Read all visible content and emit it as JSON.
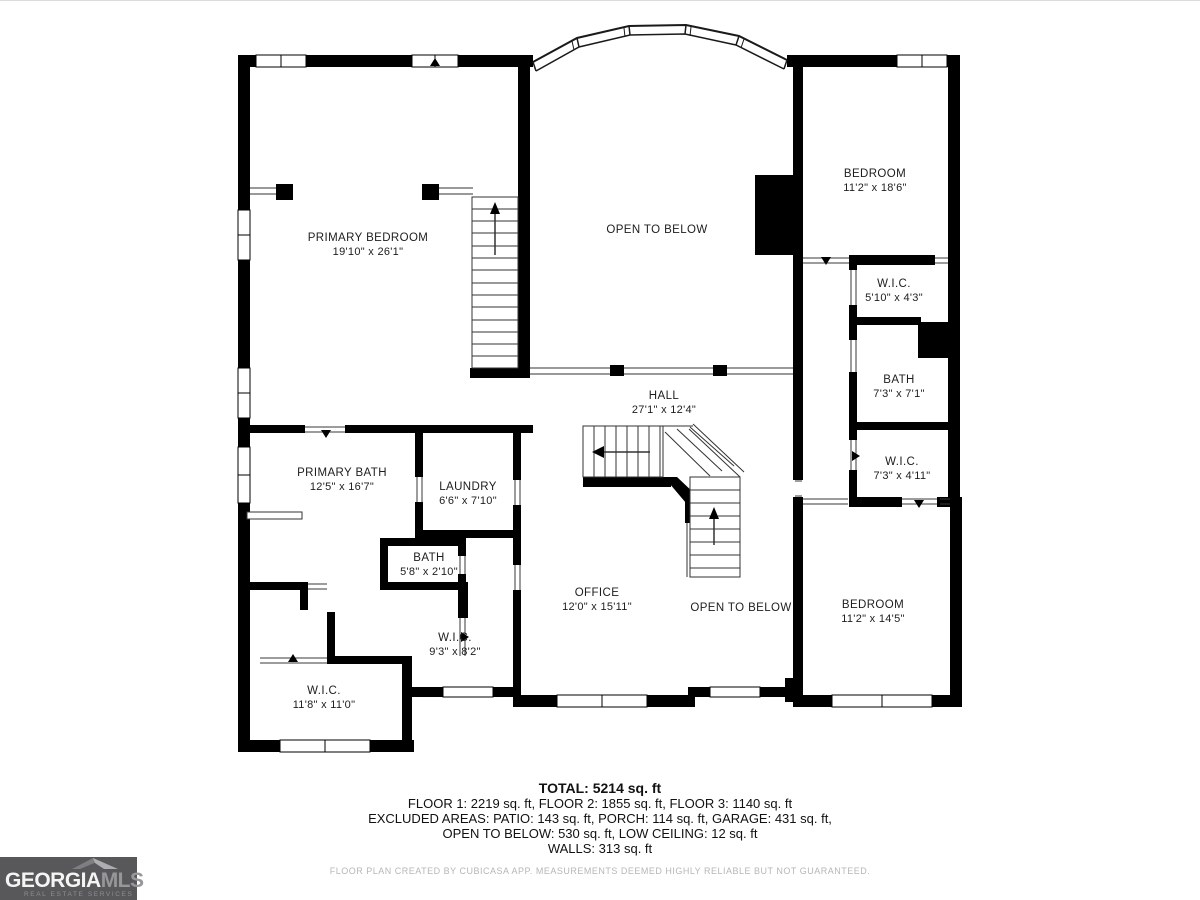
{
  "plan": {
    "rooms": [
      {
        "id": "primary-bedroom",
        "name": "PRIMARY BEDROOM",
        "dims": "19'10\" x 26'1\"",
        "cx": 368,
        "cy": 245
      },
      {
        "id": "open-to-below-upper",
        "name": "OPEN TO BELOW",
        "dims": "",
        "cx": 657,
        "cy": 230
      },
      {
        "id": "bedroom-upper-right",
        "name": "BEDROOM",
        "dims": "11'2\" x 18'6\"",
        "cx": 875,
        "cy": 181
      },
      {
        "id": "wic-510",
        "name": "W.I.C.",
        "dims": "5'10\" x 4'3\"",
        "cx": 894,
        "cy": 291
      },
      {
        "id": "bath-73-71",
        "name": "BATH",
        "dims": "7'3\" x 7'1\"",
        "cx": 899,
        "cy": 387
      },
      {
        "id": "wic-73-411",
        "name": "W.I.C.",
        "dims": "7'3\" x 4'11\"",
        "cx": 902,
        "cy": 469
      },
      {
        "id": "hall",
        "name": "HALL",
        "dims": "27'1\" x 12'4\"",
        "cx": 664,
        "cy": 403
      },
      {
        "id": "primary-bath",
        "name": "PRIMARY BATH",
        "dims": "12'5\" x 16'7\"",
        "cx": 342,
        "cy": 480
      },
      {
        "id": "laundry",
        "name": "LAUNDRY",
        "dims": "6'6\" x 7'10\"",
        "cx": 468,
        "cy": 494
      },
      {
        "id": "bath-58",
        "name": "BATH",
        "dims": "5'8\" x 2'10\"",
        "cx": 429,
        "cy": 565
      },
      {
        "id": "wic-93",
        "name": "W.I.C.",
        "dims": "9'3\" x 8'2\"",
        "cx": 455,
        "cy": 645
      },
      {
        "id": "wic-118",
        "name": "W.I.C.",
        "dims": "11'8\" x 11'0\"",
        "cx": 324,
        "cy": 698
      },
      {
        "id": "office",
        "name": "OFFICE",
        "dims": "12'0\" x 15'11\"",
        "cx": 597,
        "cy": 600
      },
      {
        "id": "open-to-below-lower",
        "name": "OPEN TO BELOW",
        "dims": "",
        "cx": 741,
        "cy": 608
      },
      {
        "id": "bedroom-lower-right",
        "name": "BEDROOM",
        "dims": "11'2\" x 14'5\"",
        "cx": 873,
        "cy": 612
      }
    ]
  },
  "summary": {
    "total": "TOTAL: 5214 sq. ft",
    "line1": "FLOOR 1: 2219 sq. ft, FLOOR 2: 1855 sq. ft, FLOOR 3: 1140 sq. ft",
    "line2": "EXCLUDED AREAS: PATIO: 143 sq. ft, PORCH: 114 sq. ft, GARAGE: 431 sq. ft,",
    "line3": "OPEN TO BELOW: 530 sq. ft, LOW CEILING: 12 sq. ft",
    "line4": "WALLS: 313 sq. ft"
  },
  "disclaimer": "FLOOR PLAN CREATED BY CUBICASA APP. MEASUREMENTS DEEMED HIGHLY RELIABLE BUT NOT GUARANTEED.",
  "logo": {
    "brand_primary": "GEORGIA",
    "brand_secondary": "MLS",
    "tagline": "REAL ESTATE SERVICES",
    "bg_color": "#58585a",
    "secondary_color": "#97979b"
  },
  "colors": {
    "wall": "#000000",
    "stair_line": "#333333",
    "label": "#1d1d1d",
    "fineprint": "#b6b6b6"
  }
}
